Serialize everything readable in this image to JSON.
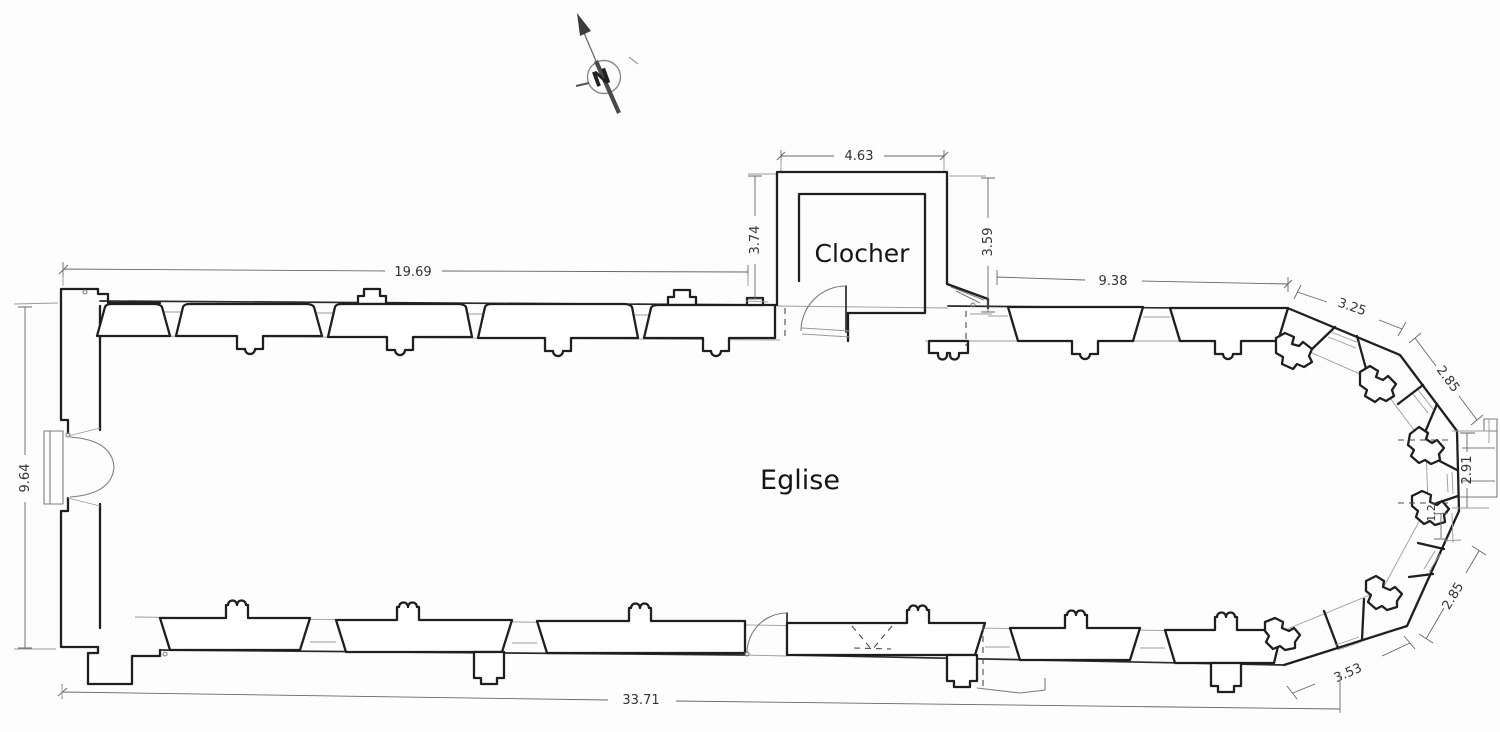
{
  "plan": {
    "type": "church floor plan",
    "tower_label": "Clocher",
    "nave_label": "Eglise",
    "north_indicator_letter": "N"
  },
  "dimensions": {
    "north_wall_west": "19.69",
    "tower_width": "4.63",
    "tower_side_left": "3.74",
    "tower_side_right": "3.59",
    "north_wall_east": "9.38",
    "apse_north_1": "3.25",
    "apse_north_2": "2.85",
    "apse_east": "2.91",
    "apse_east_small": "1.2",
    "apse_south_2": "2.85",
    "apse_south_1": "3.53",
    "south_wall_total": "33.71",
    "west_facade_width": "9.64"
  },
  "colors": {
    "ink": "#1f1f1f",
    "dimension_line": "#676767",
    "construction_line": "#9a9a9a",
    "paper": "#ffffff"
  },
  "icons": {
    "north_arrow": "compass-needle-with-N"
  }
}
